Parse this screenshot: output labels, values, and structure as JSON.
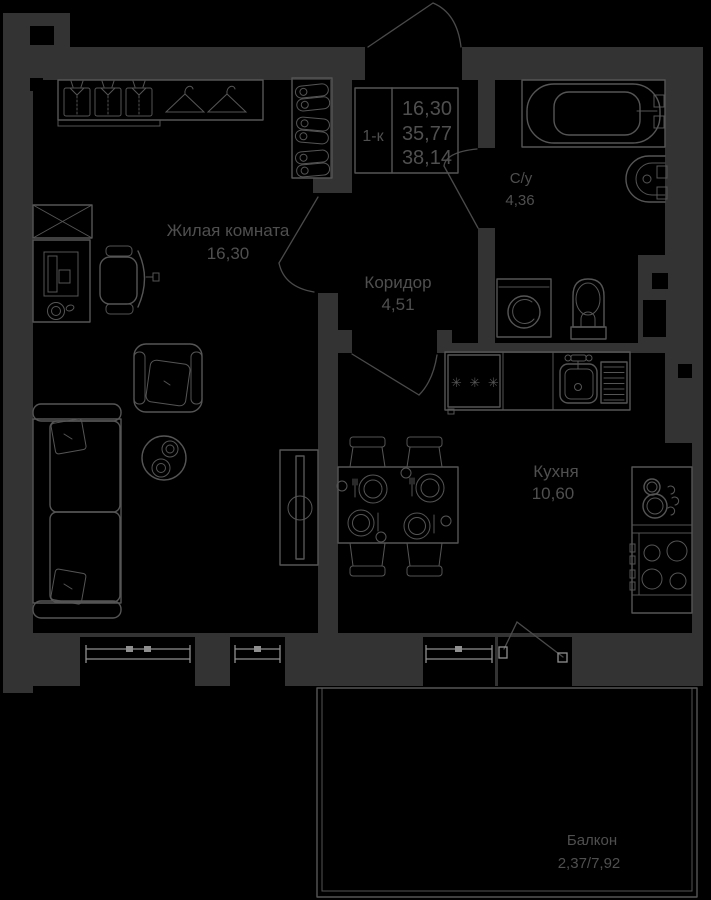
{
  "colors": {
    "bg": "#000000",
    "wall": "#333333",
    "line": "#555555",
    "line2": "#4a4a4a",
    "win": "#8f8f8f",
    "text": "#4f4f4f"
  },
  "title_block": {
    "type_label": "1-к",
    "areas": [
      "16,30",
      "35,77",
      "38,14"
    ]
  },
  "rooms": {
    "living": {
      "name": "Жилая комната",
      "area": "16,30"
    },
    "corridor": {
      "name": "Коридор",
      "area": "4,51"
    },
    "bathroom": {
      "name": "С/у",
      "area": "4,36"
    },
    "kitchen": {
      "name": "Кухня",
      "area": "10,60"
    },
    "balcony": {
      "name": "Балкон",
      "area": "2,37/7,92"
    }
  },
  "symbols": {
    "stove_burners": "✳ ✳ ✳"
  },
  "icons": {
    "shirt-icon": "folded-shirt outline",
    "hanger-icon": "clothes-hanger outline",
    "shoes-icon": "shoe pair outline",
    "monitor-icon": "desktop-monitor outline",
    "mug-icon": "cup outline",
    "tv-icon": "flat-tv on stand",
    "bathtub-icon": "bathtub outline",
    "washer-icon": "washing-machine outline",
    "toilet-icon": "toilet outline",
    "sink-icon": "sink outline",
    "plate-icon": "plate with cutlery",
    "pots-icon": "pots on counter",
    "hob-icon": "4-burner hob",
    "stove-burners-icon": "✳ ✳ ✳"
  }
}
